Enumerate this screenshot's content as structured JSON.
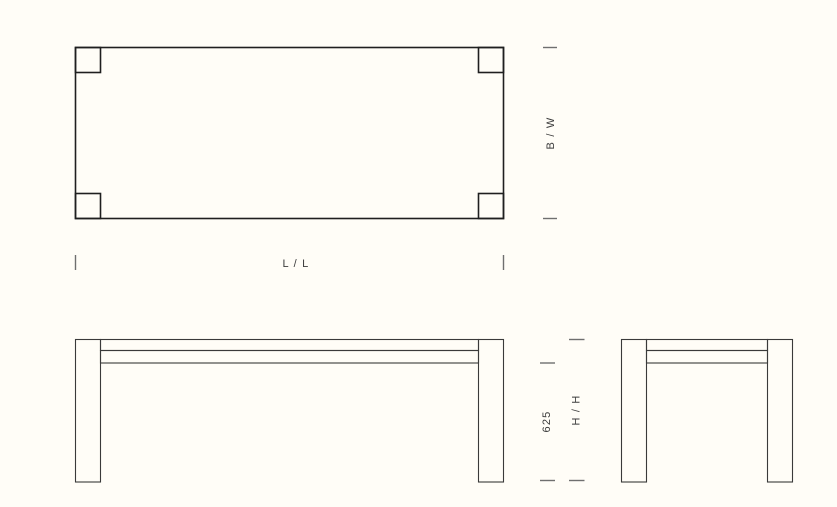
{
  "drawing": {
    "type": "furniture-technical-drawing-table",
    "views": {
      "plan": {
        "length_label": "L / L",
        "width_label": "B / W"
      },
      "elevation": {
        "clearance_label": "625",
        "height_label": "H / H"
      }
    }
  },
  "colors": {
    "background": "#fffdf7",
    "plan_line": "#1f1f1f",
    "elevation_line": "#3a3a3a",
    "tick": "#6f6f6f",
    "label_text": "#3c3c3c"
  }
}
